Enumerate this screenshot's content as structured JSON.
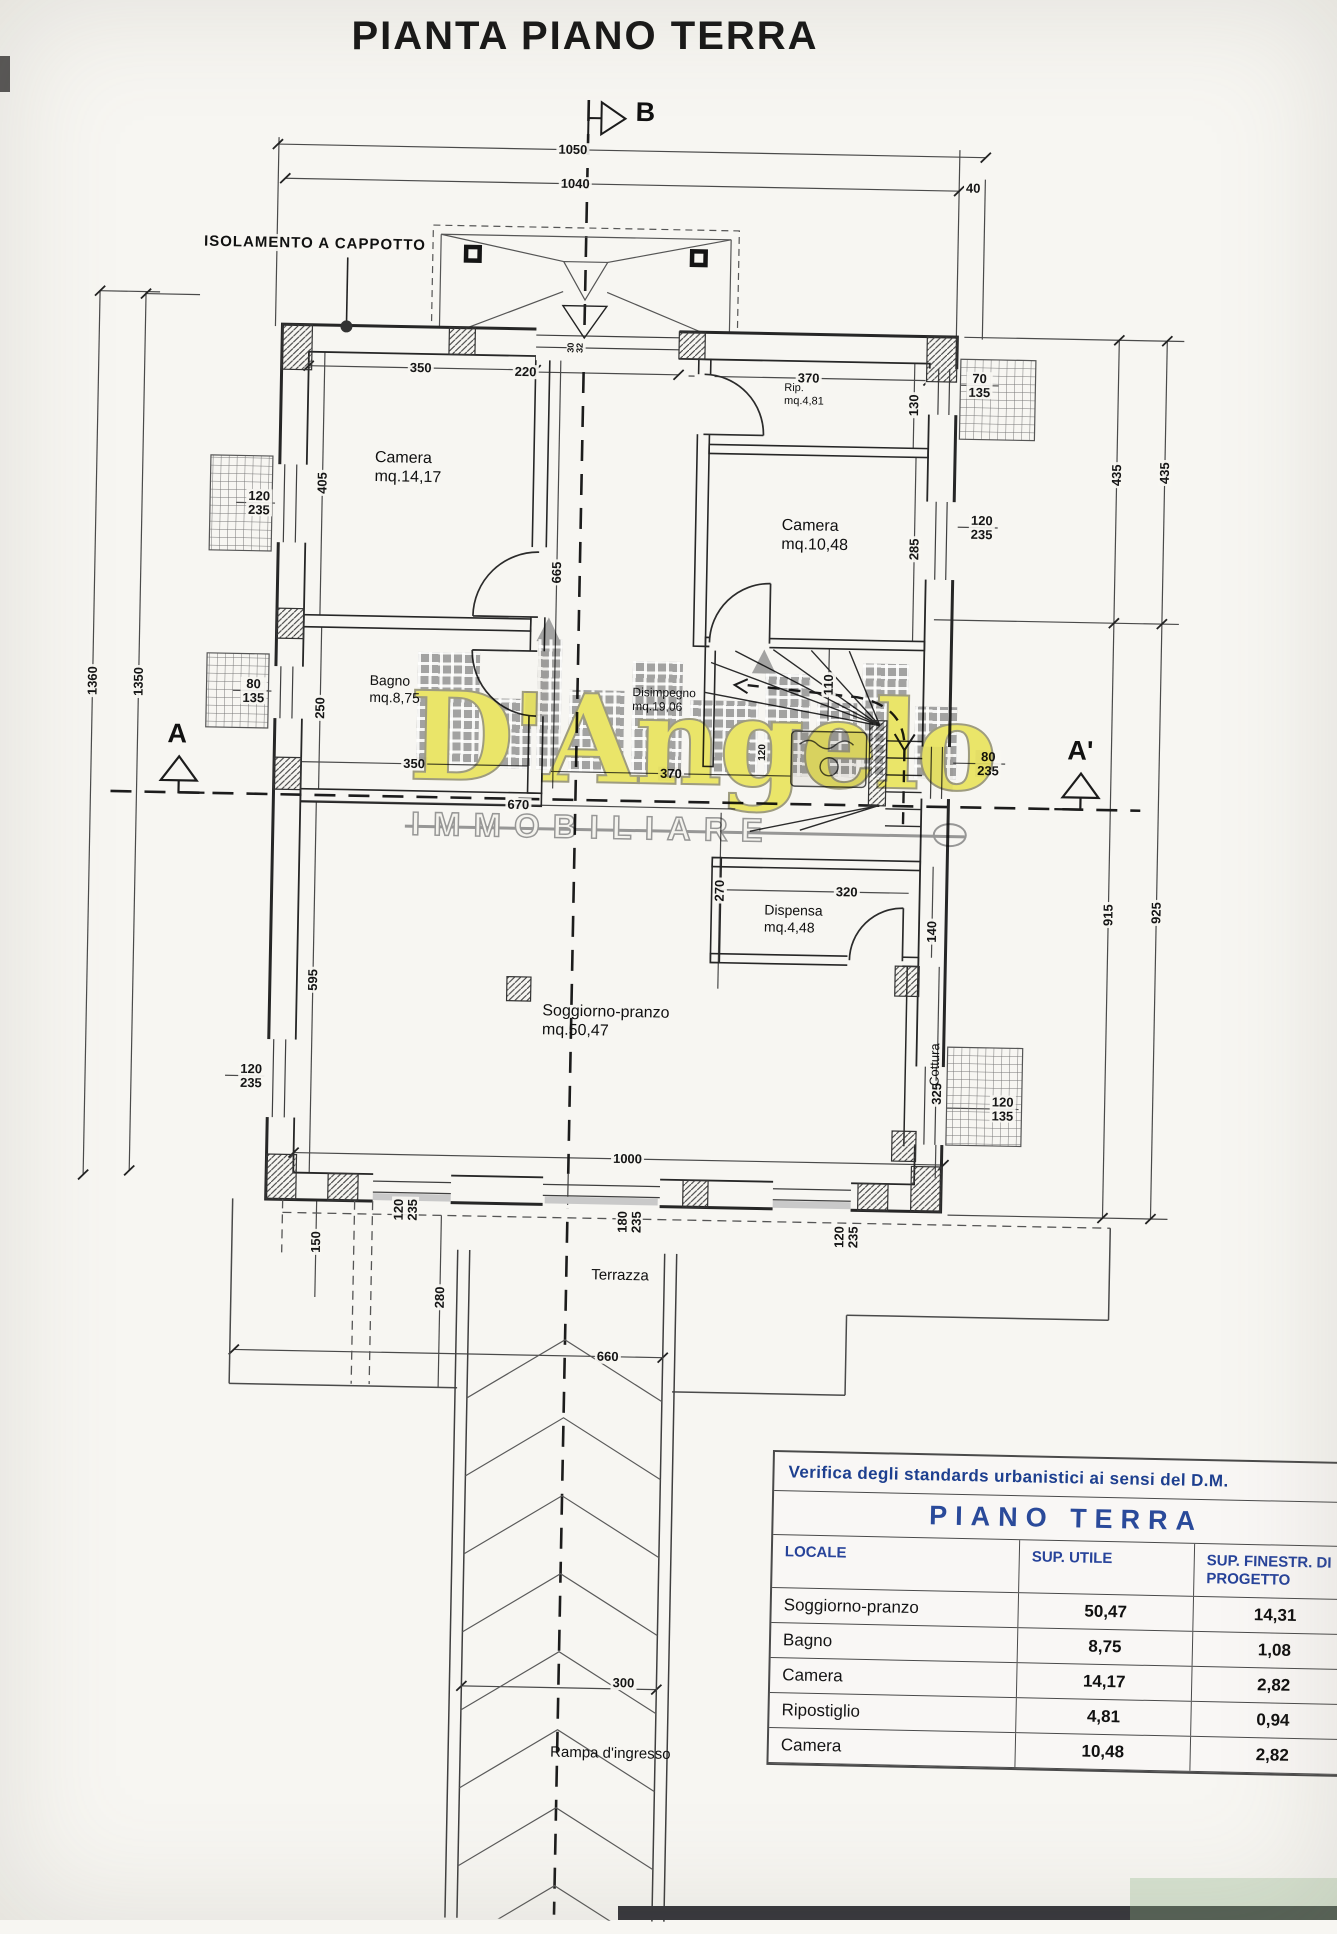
{
  "title": "PIANTA PIANO TERRA",
  "annotations": {
    "insulation_note": "ISOLAMENTO A CAPPOTTO",
    "section_marker_left": "A",
    "section_marker_right": "A'",
    "section_marker_top": "B"
  },
  "room_labels": [
    {
      "name": "Camera",
      "area": "mq.14,17",
      "x": 378,
      "y": 452,
      "size": 16
    },
    {
      "name": "Bagno",
      "area": "mq.8,75",
      "x": 377,
      "y": 676,
      "size": 14
    },
    {
      "name": "Rip.",
      "area": "mq.4,81",
      "x": 786,
      "y": 378,
      "size": 11
    },
    {
      "name": "Camera",
      "area": "mq.10,48",
      "x": 786,
      "y": 512,
      "size": 16
    },
    {
      "name": "Disimpegno",
      "area": "mq.19,06",
      "x": 640,
      "y": 684,
      "size": 12
    },
    {
      "name": "Dispensa",
      "area": "mq.4,48",
      "x": 776,
      "y": 898,
      "size": 14
    },
    {
      "name": "Soggiorno-pranzo",
      "area": "mq.50,47",
      "x": 556,
      "y": 1002,
      "size": 16
    },
    {
      "name": "Cottura",
      "area": "",
      "x": 928,
      "y": 1050,
      "rot": -90,
      "size": 13
    },
    {
      "name": "Terrazza",
      "area": "",
      "x": 610,
      "y": 1266,
      "size": 15
    },
    {
      "name": "Rampa d'ingresso",
      "area": "",
      "x": 578,
      "y": 1744,
      "size": 15
    }
  ],
  "dim_labels": [
    {
      "t": "1050",
      "x": 570,
      "y": 150
    },
    {
      "t": "1040",
      "x": 573,
      "y": 184
    },
    {
      "t": "40",
      "x": 971,
      "y": 181
    },
    {
      "t": "350",
      "x": 422,
      "y": 371
    },
    {
      "t": "220",
      "x": 527,
      "y": 373
    },
    {
      "t": "370",
      "x": 810,
      "y": 374
    },
    {
      "t": "130",
      "x": 916,
      "y": 399,
      "r": -90
    },
    {
      "t": "70\n135",
      "x": 981,
      "y": 378
    },
    {
      "t": "405",
      "x": 326,
      "y": 488,
      "r": -90
    },
    {
      "t": "120\n235",
      "x": 263,
      "y": 509
    },
    {
      "t": "665",
      "x": 562,
      "y": 573,
      "r": -90
    },
    {
      "t": "285",
      "x": 919,
      "y": 543,
      "r": -90
    },
    {
      "t": "120\n235",
      "x": 986,
      "y": 520
    },
    {
      "t": "80\n135",
      "x": 261,
      "y": 697
    },
    {
      "t": "250",
      "x": 328,
      "y": 713,
      "r": -90
    },
    {
      "t": "110",
      "x": 836,
      "y": 680,
      "r": -90
    },
    {
      "t": "120",
      "x": 772,
      "y": 749,
      "r": -90,
      "s": 10
    },
    {
      "t": "350",
      "x": 423,
      "y": 767
    },
    {
      "t": "370",
      "x": 680,
      "y": 772
    },
    {
      "t": "670",
      "x": 528,
      "y": 806
    },
    {
      "t": "80\n235",
      "x": 997,
      "y": 756
    },
    {
      "t": "320",
      "x": 858,
      "y": 887
    },
    {
      "t": "270",
      "x": 731,
      "y": 888,
      "r": -90
    },
    {
      "t": "140",
      "x": 944,
      "y": 925,
      "r": -90
    },
    {
      "t": "595",
      "x": 326,
      "y": 985,
      "r": -90
    },
    {
      "t": "325",
      "x": 952,
      "y": 1087,
      "r": -90
    },
    {
      "t": "120\n235",
      "x": 266,
      "y": 1082
    },
    {
      "t": "120\n135",
      "x": 1018,
      "y": 1101
    },
    {
      "t": "1000",
      "x": 644,
      "y": 1158
    },
    {
      "t": "120\n235",
      "x": 423,
      "y": 1213,
      "r": -90
    },
    {
      "t": "180\n235",
      "x": 647,
      "y": 1221,
      "r": -90
    },
    {
      "t": "120\n235",
      "x": 864,
      "y": 1232,
      "r": -90
    },
    {
      "t": "150",
      "x": 334,
      "y": 1247,
      "r": -90
    },
    {
      "t": "280",
      "x": 459,
      "y": 1300,
      "r": -90
    },
    {
      "t": "660",
      "x": 628,
      "y": 1356
    },
    {
      "t": "300",
      "x": 650,
      "y": 1682
    },
    {
      "t": "1360",
      "x": 100,
      "y": 690,
      "r": -90
    },
    {
      "t": "1350",
      "x": 146,
      "y": 690,
      "r": -90
    },
    {
      "t": "435",
      "x": 1120,
      "y": 465,
      "r": -90
    },
    {
      "t": "435",
      "x": 1168,
      "y": 462,
      "r": -90
    },
    {
      "t": "915",
      "x": 1120,
      "y": 905,
      "r": -90
    },
    {
      "t": "925",
      "x": 1168,
      "y": 902,
      "r": -90
    },
    {
      "t": "30\n32",
      "x": 577,
      "y": 348,
      "r": -90,
      "s": 9
    }
  ],
  "watermark": {
    "name": "D'Angelo",
    "subtitle": "IMMOBILIARE",
    "yellow": "#e9e35f",
    "gray": "#9b9b9b"
  },
  "table": {
    "title": "Verifica degli standards urbanistici ai sensi del D.M.",
    "floor_label": "PIANO TERRA",
    "columns": [
      "LOCALE",
      "SUP. UTILE",
      "SUP. FINESTR. DI PROGETTO"
    ],
    "rows": [
      {
        "locale": "Soggiorno-pranzo",
        "sup_utile": "50,47",
        "sup_finestr": "14,31"
      },
      {
        "locale": "Bagno",
        "sup_utile": "8,75",
        "sup_finestr": "1,08"
      },
      {
        "locale": "Camera",
        "sup_utile": "14,17",
        "sup_finestr": "2,82"
      },
      {
        "locale": "Ripostiglio",
        "sup_utile": "4,81",
        "sup_finestr": "0,94"
      },
      {
        "locale": "Camera",
        "sup_utile": "10,48",
        "sup_finestr": "2,82"
      }
    ]
  }
}
